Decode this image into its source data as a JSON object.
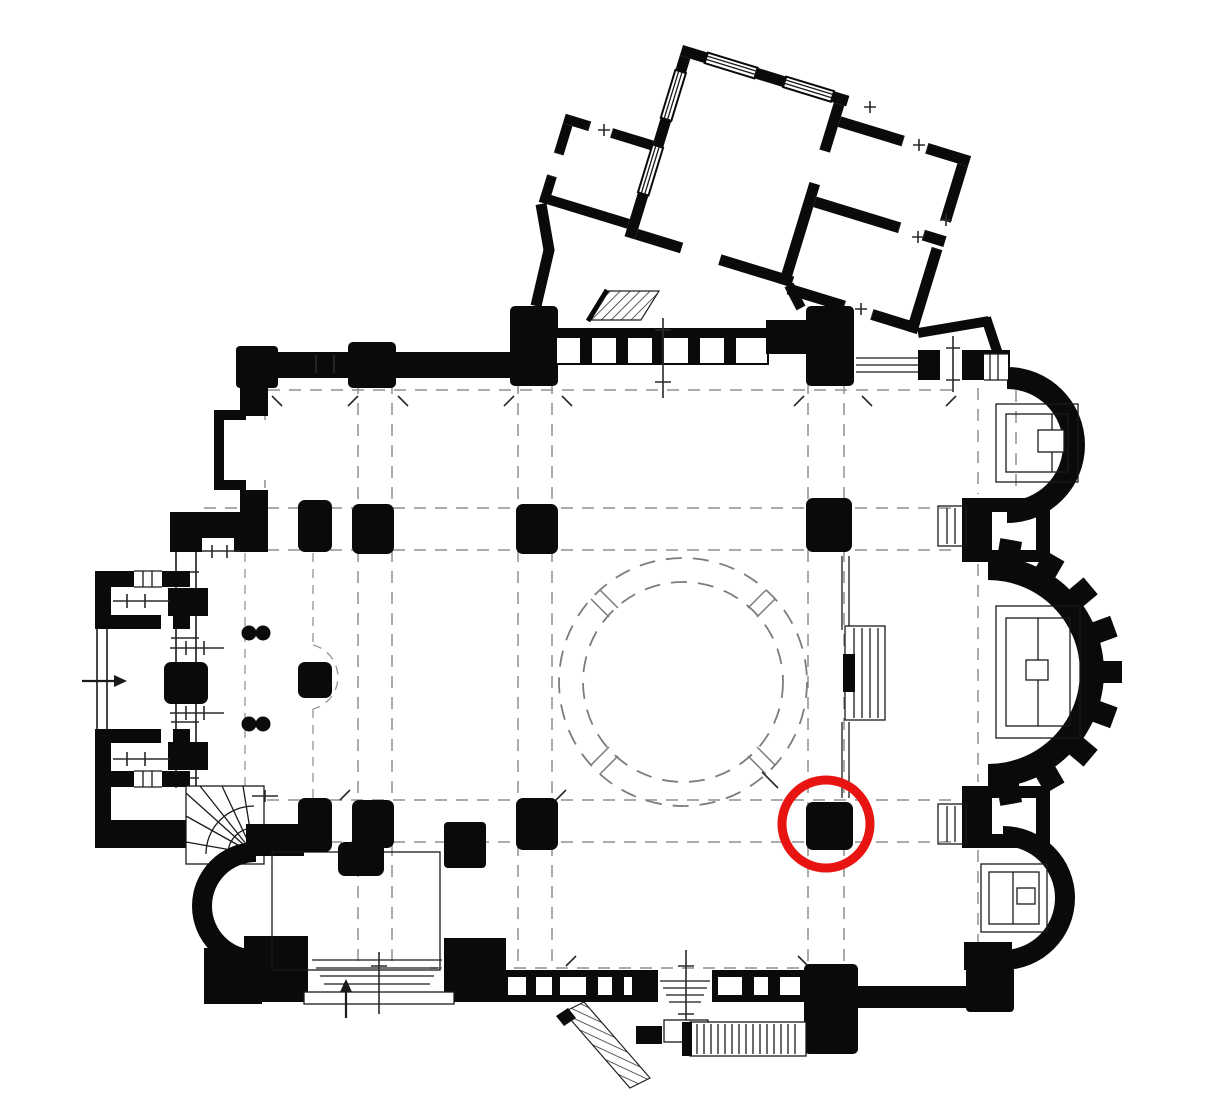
{
  "meta": {
    "title": "church-floor-plan-with-highlighted-pier",
    "type": "architectural-floor-plan",
    "width": 1227,
    "height": 1115
  },
  "colors": {
    "background": "#ffffff",
    "walls": "#0a0a0a",
    "thin_lines": "#1a1a1a",
    "dashed_lines": "#8f8f8f",
    "dome_dashed": "#7c7c7c",
    "highlight": "#e81412"
  },
  "highlight": {
    "shape": "circle",
    "cx": 826,
    "cy": 824,
    "r": 44,
    "stroke_width": 9,
    "marks": "se-crossing-pier"
  },
  "dome": {
    "cx": 683,
    "cy": 682,
    "r_outer": 124,
    "r_inner": 100
  },
  "pillars": [
    {
      "name": "nw-crossing-pier",
      "x": 516,
      "y": 504,
      "w": 42,
      "h": 50
    },
    {
      "name": "ne-crossing-pier",
      "x": 806,
      "y": 498,
      "w": 46,
      "h": 54
    },
    {
      "name": "sw-crossing-pier",
      "x": 516,
      "y": 798,
      "w": 42,
      "h": 52
    },
    {
      "name": "se-crossing-pier-highlighted",
      "x": 806,
      "y": 802,
      "w": 47,
      "h": 48
    },
    {
      "name": "west-pier-north-a",
      "x": 298,
      "y": 500,
      "w": 34,
      "h": 52
    },
    {
      "name": "west-pier-north-b",
      "x": 352,
      "y": 504,
      "w": 42,
      "h": 50
    },
    {
      "name": "west-pier-south-a",
      "x": 298,
      "y": 798,
      "w": 34,
      "h": 54
    },
    {
      "name": "west-pier-south-b",
      "x": 352,
      "y": 800,
      "w": 42,
      "h": 48
    },
    {
      "name": "west-pier-south-ext",
      "x": 338,
      "y": 842,
      "w": 46,
      "h": 34
    },
    {
      "name": "gallery-pier",
      "x": 298,
      "y": 662,
      "w": 34,
      "h": 36
    },
    {
      "name": "west-wall-pier",
      "x": 164,
      "y": 662,
      "w": 44,
      "h": 42
    }
  ],
  "paired-columns": {
    "r": 7.5,
    "points": [
      {
        "cx": 249,
        "cy": 633
      },
      {
        "cx": 263,
        "cy": 633
      },
      {
        "cx": 249,
        "cy": 724
      },
      {
        "cx": 263,
        "cy": 724
      }
    ]
  },
  "arrows": [
    {
      "name": "west-entrance-arrow",
      "x1": 82,
      "y1": 681,
      "x2": 114,
      "y2": 681,
      "dir": "right"
    },
    {
      "name": "south-chapel-entrance-arrow",
      "x1": 346,
      "y1": 1018,
      "x2": 346,
      "y2": 992,
      "dir": "up"
    }
  ]
}
